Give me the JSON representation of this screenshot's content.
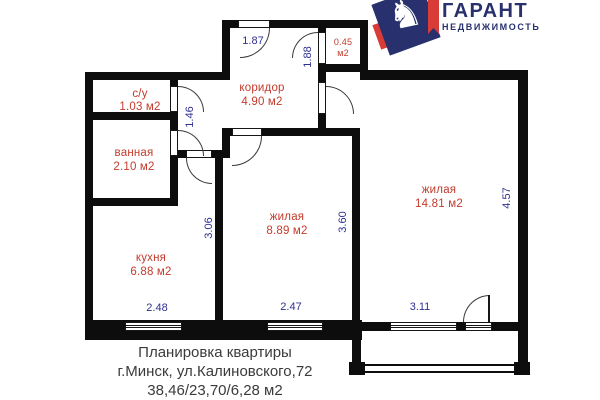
{
  "logo": {
    "title": "ГАРАНТ",
    "subtitle": "НЕДВИЖИМОСТЬ",
    "icon": "chess-knight-icon",
    "colors": {
      "navy": "#28316e",
      "red": "#d93b36"
    }
  },
  "plan": {
    "rooms": [
      {
        "id": "su",
        "name": "с/у",
        "area": "1.03 м2"
      },
      {
        "id": "vannaya",
        "name": "ванная",
        "area": "2.10 м2"
      },
      {
        "id": "kuhnya",
        "name": "кухня",
        "area": "6.88 м2"
      },
      {
        "id": "koridor",
        "name": "коридор",
        "area": "4.90 м2"
      },
      {
        "id": "zhilaya-mid",
        "name": "жилая",
        "area": "8.89 м2"
      },
      {
        "id": "zhilaya-big",
        "name": "жилая",
        "area": "14.81 м2"
      },
      {
        "id": "closet",
        "name": "0.45",
        "area": "м2"
      }
    ],
    "dimensions": {
      "entrance_width": "1.87",
      "closet_wall": "1.88",
      "vestibule": "1.46",
      "kitchen_depth": "3.06",
      "kitchen_width": "2.48",
      "mid_room_width": "2.47",
      "mid_room_depth": "3.60",
      "big_room_width": "3.11",
      "big_room_depth": "4.57"
    }
  },
  "caption": {
    "line1": "Планировка квартиры",
    "line2": "г.Минск, ул.Калиновского,72",
    "line3": "38,46/23,70/6,28 м2"
  },
  "colors": {
    "room_label": "#c23b2c",
    "dimension": "#2f3191",
    "wall": "#0d0d0d"
  }
}
